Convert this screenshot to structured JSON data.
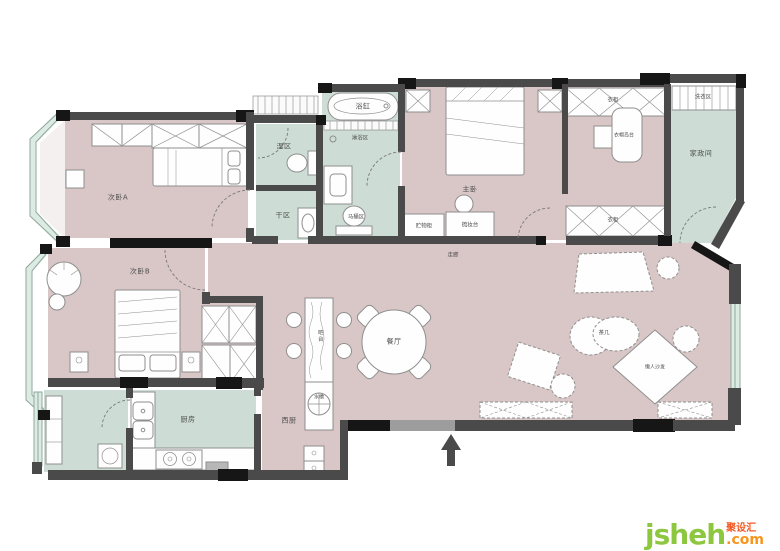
{
  "watermark": {
    "brand": "jsheh",
    "suffix": ".com",
    "cn_name": "聚设汇"
  },
  "colors": {
    "floor_warm": "#d9c6c6",
    "floor_cool": "#cddcd4",
    "wall_dark": "#4a4a4a",
    "wall_black": "#161616",
    "entry_gray": "#9d9d9d",
    "window_glass": "#dcebe3",
    "window_line": "#8fa89c",
    "furniture_stroke": "#8f8f8f",
    "furniture_fill": "#fefefe",
    "label": "#4f4f4f",
    "wm_green": "#8dc63f",
    "wm_orange": "#f7941d",
    "wm_red": "#f15a24"
  },
  "rooms": {
    "bedroom_a": "次卧A",
    "wet_zone": "湿区",
    "dry_zone": "干区",
    "master_bedroom": "主卧",
    "closet_top": "衣柜",
    "closet_island": "衣帽岛台",
    "closet_bottom": "衣柜",
    "laundry": "洗衣区",
    "utility": "家政间",
    "hallway": "走廊",
    "bedroom_b": "次卧B",
    "kitchen": "厨房",
    "west_kitchen": "西厨",
    "bar": "吧台",
    "dining": "餐厅"
  },
  "fixtures": {
    "bathtub": "浴缸",
    "shower": "淋浴区",
    "toilet": "马桶区",
    "storage_cabinet": "贮物柜",
    "dresser": "梳妆台",
    "bar_sink": "水槽",
    "coffee_table": "茶几",
    "bean_bag": "懒人沙发"
  }
}
